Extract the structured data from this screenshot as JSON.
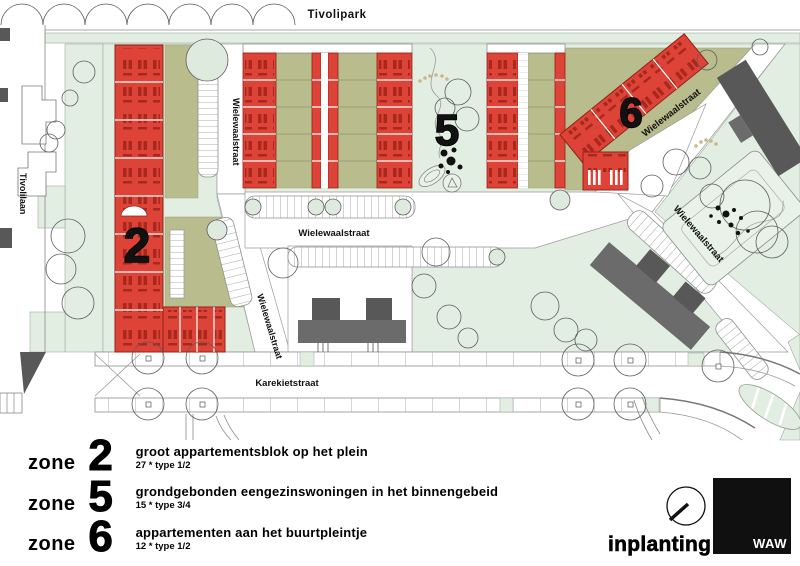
{
  "plan": {
    "park_label": "Tivolipark",
    "street_tivolilaan": "Tivolilaan",
    "street_wielewaalstraat": "Wielewaalstraat",
    "street_karekietstraat": "Karekietstraat",
    "zone2_marker": "2",
    "zone5_marker": "5",
    "zone6_marker": "6"
  },
  "legend": {
    "zone_word": "zone",
    "items": [
      {
        "number": "2",
        "title": "groot appartementsblok op het plein",
        "subtitle": "27 * type 1/2"
      },
      {
        "number": "5",
        "title": "grondgebonden eengezinswoningen in het binnengebeid",
        "subtitle": "15 * type 3/4"
      },
      {
        "number": "6",
        "title": "appartementen aan het buurtpleintje",
        "subtitle": "12 * type 1/2"
      }
    ]
  },
  "footer": {
    "drawing_title": "inplanting",
    "logo_text": "WAW"
  },
  "colors": {
    "zone_red": "#de4337",
    "zone_red_dark": "#a9281e",
    "garden_khaki": "#b9bd8e",
    "green_light": "#e3eee3",
    "building_gray": "#6b6b6b",
    "building_dark": "#585858"
  }
}
